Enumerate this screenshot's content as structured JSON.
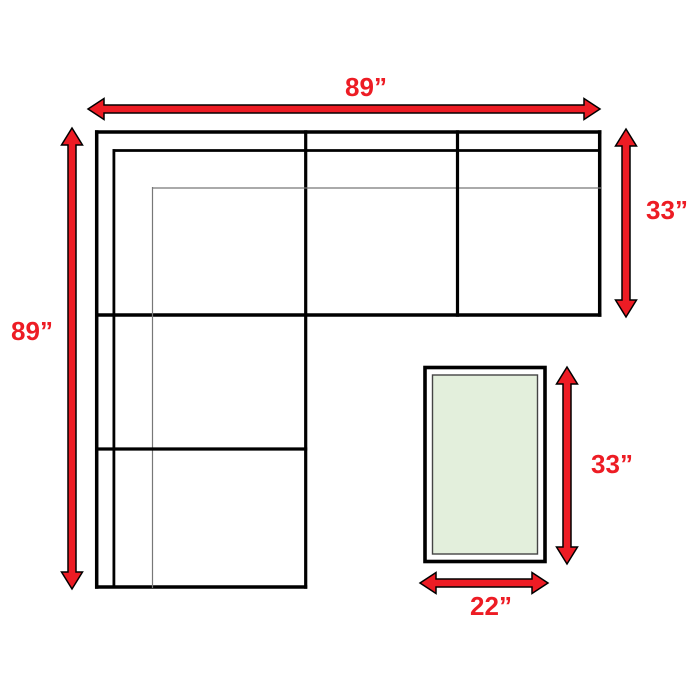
{
  "labels": {
    "sofa_total_width": "89”",
    "sofa_total_depth": "89”",
    "sofa_section_depth": "33”",
    "ottoman_length": "33”",
    "ottoman_width": "22”"
  },
  "colors": {
    "arrow_fill": "#ed1c24",
    "label_text": "#ed1c24",
    "outline_black": "#000000",
    "thin_line_gray": "#777777",
    "ottoman_fill": "#e3efdc",
    "background": "#ffffff"
  }
}
